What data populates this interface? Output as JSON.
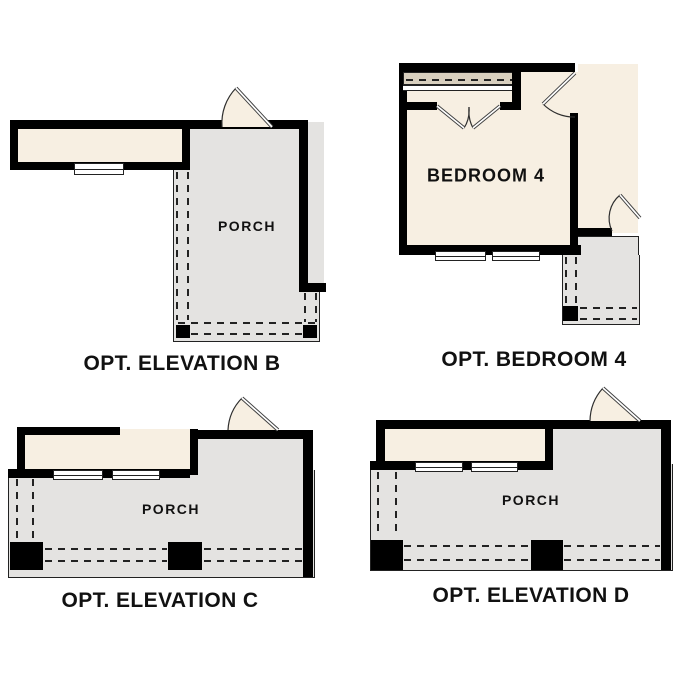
{
  "colors": {
    "wall": "#000000",
    "cream": "#f7efe2",
    "gray": "#e4e3e1",
    "tan": "#d8cfbe",
    "line": "#222222",
    "text": "#111111"
  },
  "plans": {
    "elevation_b": {
      "caption": "OPT. ELEVATION B",
      "room": "PORCH"
    },
    "bedroom_4": {
      "caption": "OPT. BEDROOM 4",
      "room": "BEDROOM 4"
    },
    "elevation_c": {
      "caption": "OPT. ELEVATION C",
      "room": "PORCH"
    },
    "elevation_d": {
      "caption": "OPT. ELEVATION D",
      "room": "PORCH"
    }
  }
}
